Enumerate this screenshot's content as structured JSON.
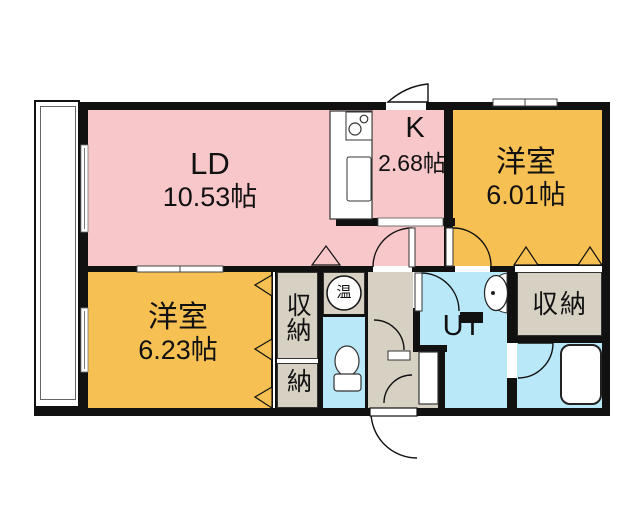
{
  "floor_plan": {
    "rooms": {
      "ld": {
        "label": "LD",
        "size": "10.53帖"
      },
      "kitchen": {
        "label": "K",
        "size": "2.68帖"
      },
      "bedroom_right": {
        "label": "洋室",
        "size": "6.01帖"
      },
      "bedroom_left": {
        "label": "洋室",
        "size": "6.23帖"
      },
      "utility": {
        "label": "UT"
      },
      "closet_left_tall": {
        "label": "収納"
      },
      "closet_left_small": {
        "label": "納"
      },
      "closet_right": {
        "label": "収納"
      },
      "water_heater": {
        "label": "温"
      }
    },
    "colors": {
      "room_pink": "#f8c7c9",
      "room_orange": "#f7c052",
      "room_cyan": "#b9e9f8",
      "closet_gray": "#d6d1c3",
      "wall_black": "#111111",
      "background": "#ffffff"
    }
  }
}
